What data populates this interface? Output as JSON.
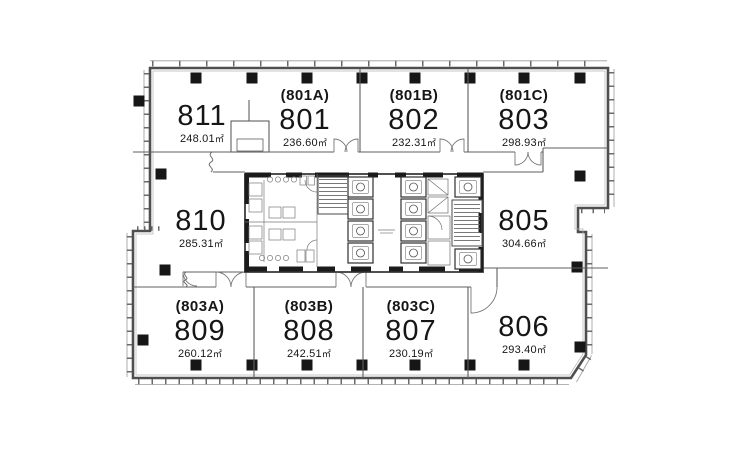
{
  "plan": {
    "floor_rooms": [
      {
        "code": "",
        "number": "811",
        "area": "248.01",
        "unit": "㎡"
      },
      {
        "code": "(801A)",
        "number": "801",
        "area": "236.60",
        "unit": "㎡"
      },
      {
        "code": "(801B)",
        "number": "802",
        "area": "232.31",
        "unit": "㎡"
      },
      {
        "code": "(801C)",
        "number": "803",
        "area": "298.93",
        "unit": "㎡"
      },
      {
        "code": "",
        "number": "810",
        "area": "285.31",
        "unit": "㎡"
      },
      {
        "code": "",
        "number": "805",
        "area": "304.66",
        "unit": "㎡"
      },
      {
        "code": "(803A)",
        "number": "809",
        "area": "260.12",
        "unit": "㎡"
      },
      {
        "code": "(803B)",
        "number": "808",
        "area": "242.51",
        "unit": "㎡"
      },
      {
        "code": "(803C)",
        "number": "807",
        "area": "230.19",
        "unit": "㎡"
      },
      {
        "code": "",
        "number": "806",
        "area": "293.40",
        "unit": "㎡"
      }
    ],
    "colors": {
      "wall": "#4f4f4f",
      "thin_line": "#6f6f6f",
      "column": "#161616",
      "text": "#161616",
      "background": "#ffffff"
    }
  }
}
